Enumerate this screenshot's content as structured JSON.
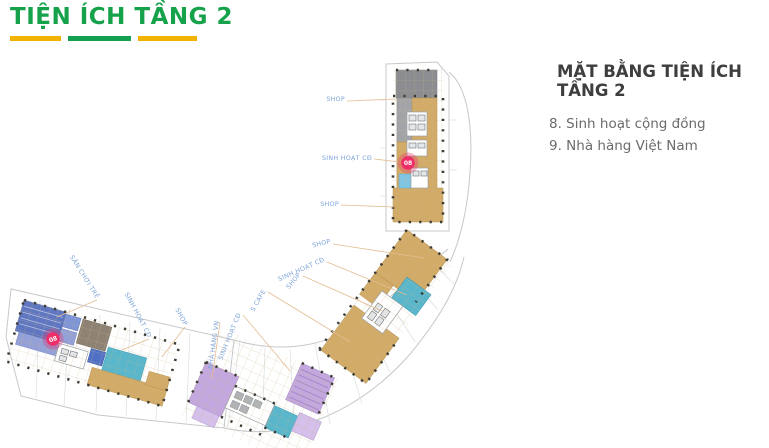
{
  "header": {
    "title": "TIỆN ÍCH TẦNG 2",
    "title_color": "#16a24b",
    "underline_colors": [
      "#f2b200",
      "#13a050",
      "#f2b200"
    ]
  },
  "legend": {
    "heading": "MẶT BẰNG TIỆN ÍCH TẦNG 2",
    "items": [
      "8. Sinh hoạt cộng đồng",
      "9. Nhà hàng Việt Nam"
    ]
  },
  "plan": {
    "palette": {
      "tan": "#d2ab68",
      "dark_gray": "#8b8d90",
      "gray": "#a2a4a7",
      "teal": "#59b6cb",
      "cyan": "#7fc6e4",
      "indigo": "#5f76c0",
      "indigo_light": "#93a1d8",
      "blue": "#7e95d6",
      "royal": "#4f70c6",
      "brown": "#8e8274",
      "purple": "#c3a8df",
      "purple_light": "#d4c0ea",
      "marker_pink": "#ee2e67",
      "leader": "#e3bd92",
      "label_text": "#7fa5d9",
      "boundary": "#c5c8cb",
      "column_dot": "#3c3c34"
    },
    "markers": [
      {
        "id": "08",
        "x": 408,
        "y": 163,
        "rotate": 0
      },
      {
        "id": "08",
        "x": 53,
        "y": 339,
        "rotate": -18
      }
    ],
    "labels": [
      {
        "text": "SHOP",
        "x": 345,
        "y": 101,
        "rotate": 0
      },
      {
        "text": "SINH HOẠT CĐ",
        "x": 372,
        "y": 160,
        "rotate": 0
      },
      {
        "text": "SHOP",
        "x": 339,
        "y": 206,
        "rotate": 0
      },
      {
        "text": "SHOP",
        "x": 331,
        "y": 243,
        "rotate": -14
      },
      {
        "text": "SINH HOẠT CĐ",
        "x": 325,
        "y": 261,
        "rotate": -24
      },
      {
        "text": "SHOP",
        "x": 301,
        "y": 275,
        "rotate": -50
      },
      {
        "text": "S CAFE",
        "x": 266,
        "y": 291,
        "rotate": -60
      },
      {
        "text": "SINH HOẠT CĐ",
        "x": 241,
        "y": 314,
        "rotate": -68
      },
      {
        "text": "NHÀ HÀNG VN",
        "x": 219,
        "y": 321,
        "rotate": -82
      },
      {
        "text": "SHOP",
        "x": 184,
        "y": 326,
        "rotate": 62
      },
      {
        "text": "SINH HOẠT CĐ",
        "x": 148,
        "y": 338,
        "rotate": 62
      },
      {
        "text": "SÂN CHƠI TRẺ",
        "x": 96,
        "y": 299,
        "rotate": 58
      }
    ],
    "leaders": [
      [
        347,
        101,
        396,
        99
      ],
      [
        374,
        159,
        399,
        162
      ],
      [
        341,
        205,
        394,
        207
      ],
      [
        333,
        244,
        424,
        258
      ],
      [
        327,
        262,
        407,
        295
      ],
      [
        303,
        276,
        382,
        311
      ],
      [
        268,
        292,
        350,
        342
      ],
      [
        243,
        315,
        290,
        371
      ],
      [
        220,
        322,
        212,
        379
      ],
      [
        185,
        327,
        162,
        357
      ],
      [
        149,
        339,
        122,
        350
      ],
      [
        97,
        300,
        57,
        317
      ]
    ]
  }
}
